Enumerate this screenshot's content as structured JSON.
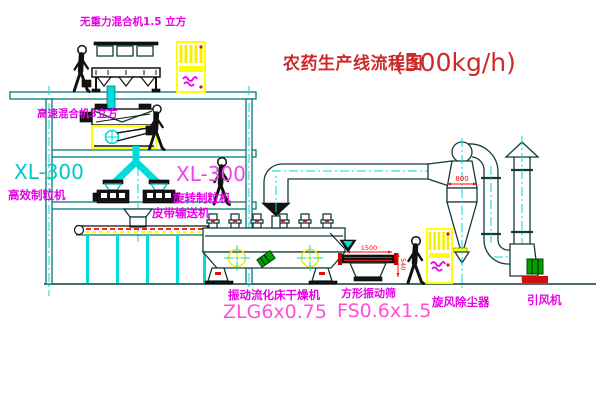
{
  "title": {
    "text": "农药生产线流程图",
    "capacity": "(500kg/h)"
  },
  "equipment": {
    "top_mixer": {
      "label": "无重力混合机1.5 立方"
    },
    "mid_mixer": {
      "label": "高速混合机3立方"
    },
    "granulator_left": {
      "model": "XL-300",
      "label": "高效制粒机"
    },
    "granulator_right": {
      "model": "XL-300",
      "label": "旋转制粒机"
    },
    "belt_conveyor": {
      "label": "皮带输送机"
    },
    "dryer": {
      "label": "振动流化床干燥机",
      "model": "ZLG6x0.75"
    },
    "sieve": {
      "label": "方形振动筛",
      "model": "FS0.6x1.5",
      "dim_length": "1500",
      "dim_height": "540"
    },
    "cyclone": {
      "label": "旋风除尘器",
      "dim_diameter": "800"
    },
    "fan": {
      "label": "引风机"
    }
  },
  "colors": {
    "structure_teal": "#007a7a",
    "machinery_dark": "#113b3b",
    "pipe_cyan": "#00dcdc",
    "label_magenta": "#e800e8",
    "model_pink": "#ff4fd8",
    "model_cyan": "#00c8c8",
    "title_red": "#cc2b2b",
    "dimension_red": "#ff0000",
    "cabinet_yellow": "#ffff00",
    "motor_green": "#009a00"
  }
}
